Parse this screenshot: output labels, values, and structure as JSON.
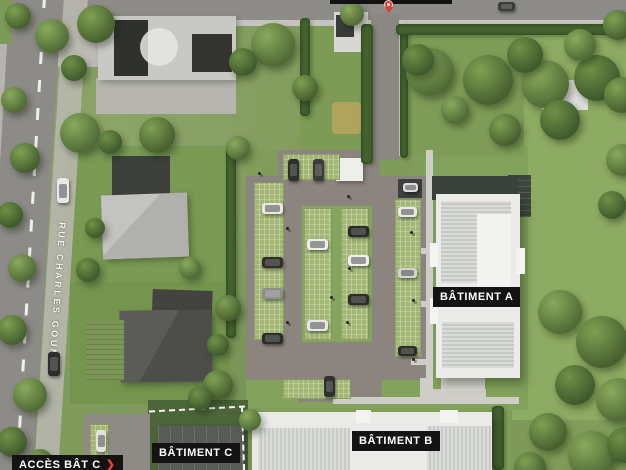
{
  "labels": {
    "street_name": "RUE CHARLES GOUNOD",
    "building_a": "BÂTIMENT A",
    "building_b": "BÂTIMENT B",
    "building_c": "BÂTIMENT C",
    "access_c": "ACCÈS BÂT C",
    "access_arrow": "❯"
  },
  "colors": {
    "label_bg": "#131313",
    "label_text": "#ffffff",
    "access_arrow_red": "#e8413c",
    "pin_red": "#e0392f",
    "road_asphalt": "#8d8b87",
    "parking_asphalt": "#8c857f",
    "grass_base": "#7d9a56",
    "lawn_bright": "#8dab62",
    "building_white": "#ebecea",
    "boundary_dash": "#ffffff"
  },
  "scenery": {
    "trees": [
      [
        18,
        16,
        13,
        0
      ],
      [
        52,
        36,
        17,
        1
      ],
      [
        96,
        24,
        19,
        0
      ],
      [
        74,
        68,
        13,
        2
      ],
      [
        273,
        45,
        22,
        1
      ],
      [
        243,
        62,
        14,
        2
      ],
      [
        305,
        88,
        13,
        0
      ],
      [
        80,
        133,
        20,
        1
      ],
      [
        157,
        135,
        18,
        0
      ],
      [
        110,
        142,
        12,
        2
      ],
      [
        14,
        100,
        13,
        1
      ],
      [
        25,
        158,
        15,
        0
      ],
      [
        10,
        215,
        13,
        2
      ],
      [
        22,
        268,
        14,
        1
      ],
      [
        12,
        330,
        15,
        0
      ],
      [
        30,
        395,
        17,
        1
      ],
      [
        12,
        442,
        15,
        2
      ],
      [
        40,
        462,
        13,
        0
      ],
      [
        88,
        270,
        12,
        2
      ],
      [
        218,
        385,
        15,
        0
      ],
      [
        200,
        398,
        12,
        2
      ],
      [
        250,
        420,
        11,
        1
      ],
      [
        430,
        72,
        24,
        1
      ],
      [
        488,
        80,
        25,
        0
      ],
      [
        545,
        84,
        24,
        1
      ],
      [
        597,
        78,
        23,
        2
      ],
      [
        622,
        95,
        18,
        0
      ],
      [
        525,
        55,
        18,
        2
      ],
      [
        580,
        45,
        16,
        1
      ],
      [
        618,
        25,
        15,
        0
      ],
      [
        622,
        160,
        16,
        1
      ],
      [
        612,
        205,
        14,
        2
      ],
      [
        560,
        312,
        22,
        1
      ],
      [
        602,
        342,
        26,
        0
      ],
      [
        575,
        385,
        20,
        2
      ],
      [
        618,
        400,
        22,
        1
      ],
      [
        548,
        432,
        19,
        0
      ],
      [
        592,
        455,
        24,
        1
      ],
      [
        625,
        445,
        18,
        2
      ],
      [
        530,
        468,
        16,
        0
      ],
      [
        418,
        60,
        16,
        2
      ],
      [
        455,
        110,
        14,
        1
      ],
      [
        505,
        130,
        16,
        0
      ],
      [
        560,
        120,
        20,
        2
      ],
      [
        238,
        148,
        12,
        1
      ],
      [
        95,
        228,
        10,
        2
      ],
      [
        190,
        268,
        11,
        1
      ],
      [
        228,
        308,
        13,
        0
      ],
      [
        218,
        345,
        11,
        2
      ],
      [
        352,
        14,
        12,
        1
      ]
    ],
    "hedges": [
      [
        226,
        146,
        10,
        192
      ],
      [
        300,
        18,
        10,
        98
      ],
      [
        361,
        24,
        12,
        140
      ],
      [
        400,
        24,
        8,
        134
      ],
      [
        396,
        24,
        230,
        11
      ],
      [
        492,
        406,
        12,
        64
      ]
    ],
    "cars": [
      [
        57,
        178,
        12,
        25,
        "#e9e9e7"
      ],
      [
        48,
        352,
        12,
        24,
        "#2d2d2b"
      ],
      [
        498,
        2,
        17,
        9,
        "#3c3c3a"
      ],
      [
        96,
        430,
        10,
        22,
        "#e2e2e0"
      ],
      [
        288,
        159,
        11,
        22,
        "#2f2f2d"
      ],
      [
        313,
        159,
        11,
        22,
        "#3b3b39"
      ],
      [
        262,
        203,
        21,
        11,
        "#e8e8e6"
      ],
      [
        262,
        257,
        21,
        11,
        "#2e2e2c"
      ],
      [
        262,
        288,
        21,
        11,
        "#8e8e8c"
      ],
      [
        262,
        333,
        21,
        11,
        "#2b2b29"
      ],
      [
        307,
        239,
        21,
        11,
        "#ededeb"
      ],
      [
        307,
        320,
        21,
        11,
        "#e7e7e5"
      ],
      [
        348,
        226,
        21,
        11,
        "#2a2a28"
      ],
      [
        348,
        255,
        21,
        11,
        "#f0f0ee"
      ],
      [
        348,
        294,
        21,
        11,
        "#2d2d2b"
      ],
      [
        398,
        207,
        19,
        10,
        "#e9e9e7"
      ],
      [
        398,
        268,
        19,
        10,
        "#d2d2d0"
      ],
      [
        398,
        346,
        19,
        10,
        "#2c2c2a"
      ],
      [
        324,
        376,
        11,
        21,
        "#30302e"
      ],
      [
        403,
        183,
        15,
        9,
        "#dcdcda"
      ]
    ],
    "lamps": [
      [
        347,
        195
      ],
      [
        286,
        227
      ],
      [
        348,
        267
      ],
      [
        330,
        296
      ],
      [
        410,
        231
      ],
      [
        412,
        299
      ],
      [
        346,
        321
      ],
      [
        286,
        321
      ],
      [
        412,
        358
      ],
      [
        258,
        172
      ]
    ],
    "paths": [
      [
        426,
        150,
        7,
        250
      ],
      [
        411,
        248,
        16,
        6
      ],
      [
        411,
        301,
        16,
        6
      ],
      [
        411,
        359,
        16,
        6
      ],
      [
        333,
        397,
        186,
        7
      ],
      [
        296,
        380,
        8,
        19
      ],
      [
        420,
        378,
        10,
        21
      ],
      [
        466,
        384,
        8,
        15
      ],
      [
        488,
        397,
        30,
        7
      ],
      [
        432,
        389,
        54,
        8
      ]
    ],
    "stalls": [
      [
        254,
        182,
        30,
        158
      ],
      [
        283,
        154,
        57,
        26
      ],
      [
        304,
        208,
        28,
        132
      ],
      [
        341,
        208,
        28,
        132
      ],
      [
        395,
        199,
        26,
        158
      ],
      [
        283,
        379,
        68,
        20
      ],
      [
        90,
        424,
        19,
        32
      ]
    ]
  }
}
